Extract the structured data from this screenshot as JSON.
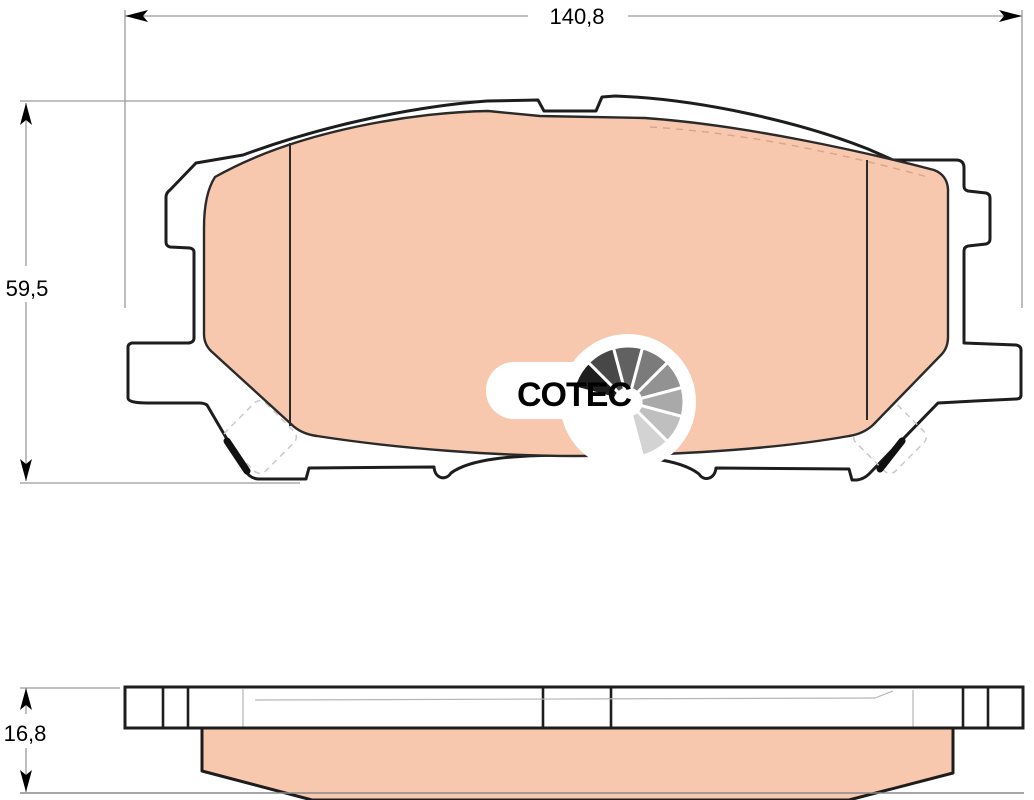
{
  "drawing": {
    "type": "brake-pad technical drawing",
    "dimension_labels": {
      "width": "140,8",
      "height": "59,5",
      "thickness": "16,8"
    },
    "logo": {
      "text": "COTEC"
    },
    "colors": {
      "background": "#ffffff",
      "friction_material": "#f7c7ae",
      "outline": "#1d1d1d",
      "dimension_line": "#9b9b9b",
      "hidden_line": "#b5b5b5",
      "clip_dashed": "#c9c9c9",
      "friction_dashed_edge": "#d8a48e",
      "gauge_shades": [
        "#1e1e1e",
        "#474747",
        "#616161",
        "#7b7b7b",
        "#929292",
        "#a9a9a9",
        "#bfbfbf",
        "#d3d3d3"
      ]
    }
  }
}
